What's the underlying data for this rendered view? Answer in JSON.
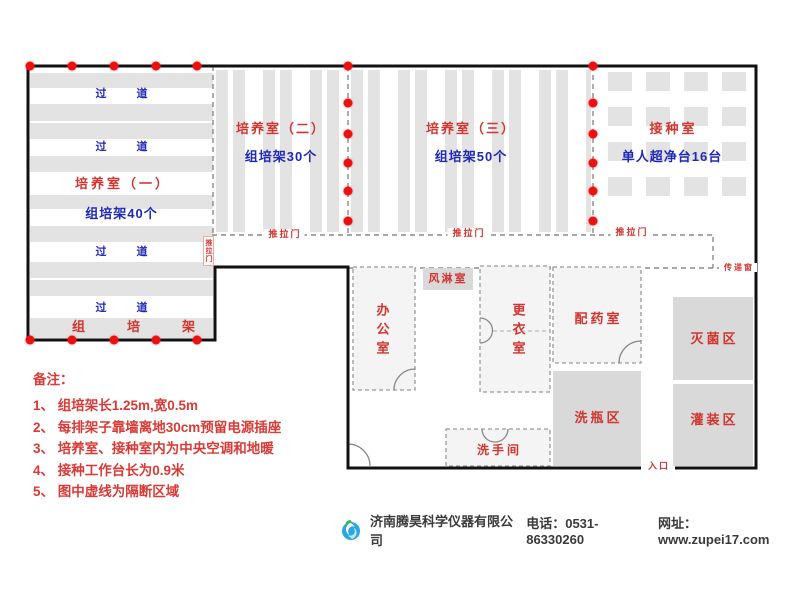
{
  "plan": {
    "culture_room_1": {
      "title": "培养室（一）",
      "racks": "组培架40个",
      "aisle": "过道",
      "rack_row": "组培架"
    },
    "culture_room_2": {
      "title": "培养室（二）",
      "racks": "组培架30个"
    },
    "culture_room_3": {
      "title": "培养室（三）",
      "racks": "组培架50个"
    },
    "inoculation_room": {
      "title": "接种室",
      "benches": "单人超净台16台"
    },
    "office": {
      "title": "办公室"
    },
    "air_shower": {
      "title": "风淋室"
    },
    "changing_room": {
      "title": "更衣室"
    },
    "dispensing_room": {
      "title": "配药室"
    },
    "bottle_washing_zone": {
      "title": "洗瓶区"
    },
    "sterilization_zone": {
      "title": "灭菌区"
    },
    "filling_zone": {
      "title": "灌装区"
    },
    "restroom": {
      "title": "洗手间"
    },
    "sliding_door": "推拉门",
    "pass_window": "传递窗",
    "entrance": "入口"
  },
  "notes": {
    "title": "备注：",
    "items": [
      "1、 组培架长1.25m,宽0.5m",
      "2、 每排架子靠墙离地30cm预留电源插座",
      "3、 培养室、接种室内为中央空调和地暖",
      "4、 接种工作台长为0.9米",
      "5、 图中虚线为隔断区域"
    ]
  },
  "footer": {
    "company": "济南腾昊科学仪器有限公司",
    "phone": "电话：0531-86330260",
    "website": "网址：www.zupei17.com"
  },
  "colors": {
    "label_red": "#d2342f",
    "label_blue": "#2028b8",
    "dot_red": "#ec1111",
    "shelf_gray": "#e3e3e3",
    "zone_gray": "#d9d9d9",
    "wall_black": "#111111",
    "logo_green": "#4cb648",
    "logo_blue": "#29a8df"
  }
}
